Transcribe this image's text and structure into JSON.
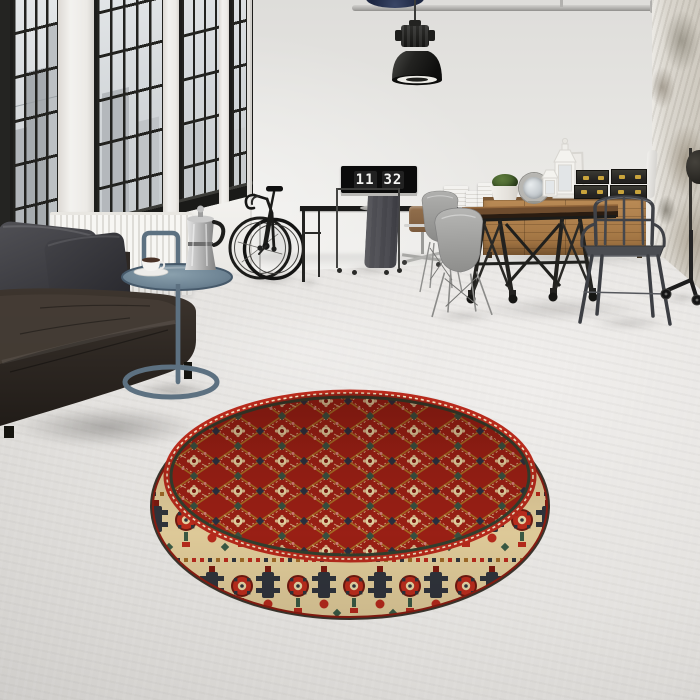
{
  "meta": {
    "type": "interior-photograph",
    "description": "Industrial loft living space: black-framed factory windows with city view, dark leather sofa, steel tray side table with moka pot and espresso cup, road bicycle, desk with flip-clock monitor, wooden sideboard with lanterns and storage trunks, trestle dining table with shell chairs and metal armchair, pendant lamp, and a round red oriental rug on a grey concrete floor."
  },
  "clock": {
    "hours": "11",
    "minutes": "32"
  },
  "palette": {
    "wall": "#e7e6e3",
    "floor": "#d8d6d3",
    "window_frame": "#1d1d1b",
    "city_silhouette": "#aeb3b8",
    "sofa_leather": "#332c27",
    "pillow_grey": "#44444a",
    "radiator_white": "#f6f5f2",
    "side_table_steel": "#5d7181",
    "moka_silver": "#c9c9c9",
    "desk_black": "#1a1a19",
    "monitor_black": "#0b0b0b",
    "digit_white": "#f5f5f3",
    "table_wood": "#6e4c2e",
    "sideboard_wood": "#ab7f4e",
    "trunk_black": "#2c2b27",
    "brass": "#c9a43c",
    "shell_chair_grey": "#a9a9a7",
    "tolix_gunmetal": "#45474b",
    "plant_green": "#4e6b33",
    "rug_red": "#9c2015",
    "rug_cream": "#e2cd9b",
    "rug_navy": "#30343c",
    "rug_green": "#375241",
    "rug_gold": "#a86f24",
    "rug_pink": "#d2837a",
    "lamp_black": "#1f1f1d",
    "column_grunge": "#dbd7cf"
  },
  "objects": [
    "industrial-windows-with-city-view",
    "white-radiator",
    "leather-sofa",
    "grey-pillows",
    "steel-tray-side-table",
    "moka-pot",
    "espresso-cup",
    "road-bicycle",
    "black-console-desk",
    "monitor-flip-clock",
    "clothes-rack-with-garment",
    "wooden-office-chair",
    "grey-shell-dining-chairs",
    "trestle-dining-table-on-casters",
    "wooden-sideboard",
    "black-storage-trunks-with-brass-latches",
    "white-lanterns",
    "round-ornate-mirror",
    "potted-green-plant",
    "metal-armchair",
    "pendant-industrial-lamp",
    "ceiling-pipe",
    "distressed-plaster-column",
    "caster-stool-base",
    "round-red-oriental-rug"
  ]
}
